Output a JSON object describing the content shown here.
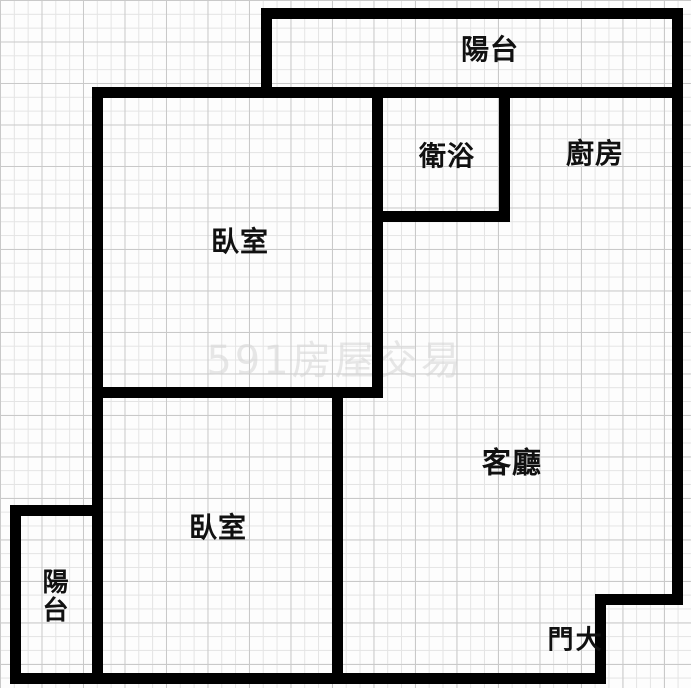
{
  "plan": {
    "title": "apartment-floor-plan",
    "rooms": {
      "balcony_top": {
        "label": "陽台"
      },
      "bathroom": {
        "label": "衛浴"
      },
      "kitchen": {
        "label": "廚房"
      },
      "bedroom_upper": {
        "label": "臥室"
      },
      "bedroom_lower": {
        "label": "臥室"
      },
      "living_room": {
        "label": "客廳"
      },
      "balcony_lower": {
        "label": "陽台"
      },
      "main_door": {
        "label": "大門"
      }
    },
    "watermark": {
      "text": "591房屋交易"
    },
    "colors": {
      "wall": "#000000",
      "label_text": "#111111",
      "grid_minor": "#e4e4e4",
      "grid_major": "#c9c9c9",
      "background": "#fdfdfd"
    }
  }
}
